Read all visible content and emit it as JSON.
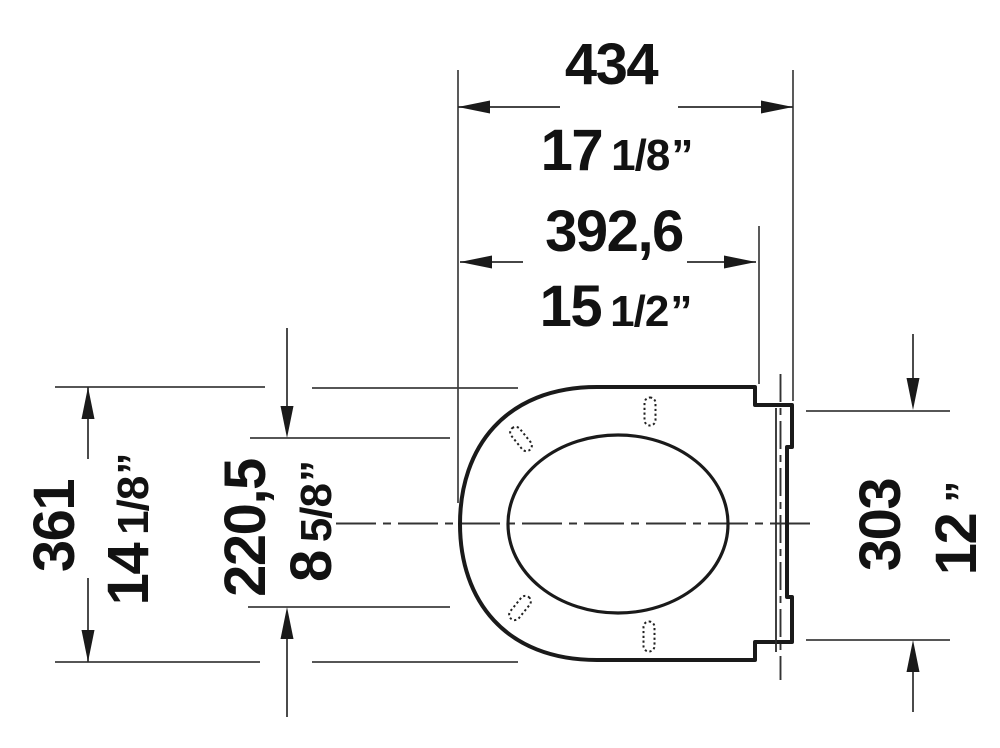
{
  "drawing": {
    "subject": "toilet-seat-top-view-dimension-drawing",
    "background_color": "#ffffff",
    "ink_color": "#1a1a1a",
    "thin_line_color": "#3e3e3e",
    "units": {
      "primary": "mm",
      "secondary": "inch"
    },
    "dims": {
      "top_outer": {
        "metric": "434",
        "whole": "17",
        "frac": "1/8",
        "mark": "”"
      },
      "top_inner": {
        "metric": "392,6",
        "whole": "15",
        "frac": "1/2",
        "mark": "”"
      },
      "left_outer": {
        "metric": "361",
        "whole": "14",
        "frac": "1/8",
        "mark": "”"
      },
      "left_inner": {
        "metric": "220,5",
        "whole": "8",
        "frac": "5/8",
        "mark": "”"
      },
      "right_side": {
        "metric": "303",
        "whole": "12",
        "frac": "",
        "mark": "”"
      }
    }
  }
}
